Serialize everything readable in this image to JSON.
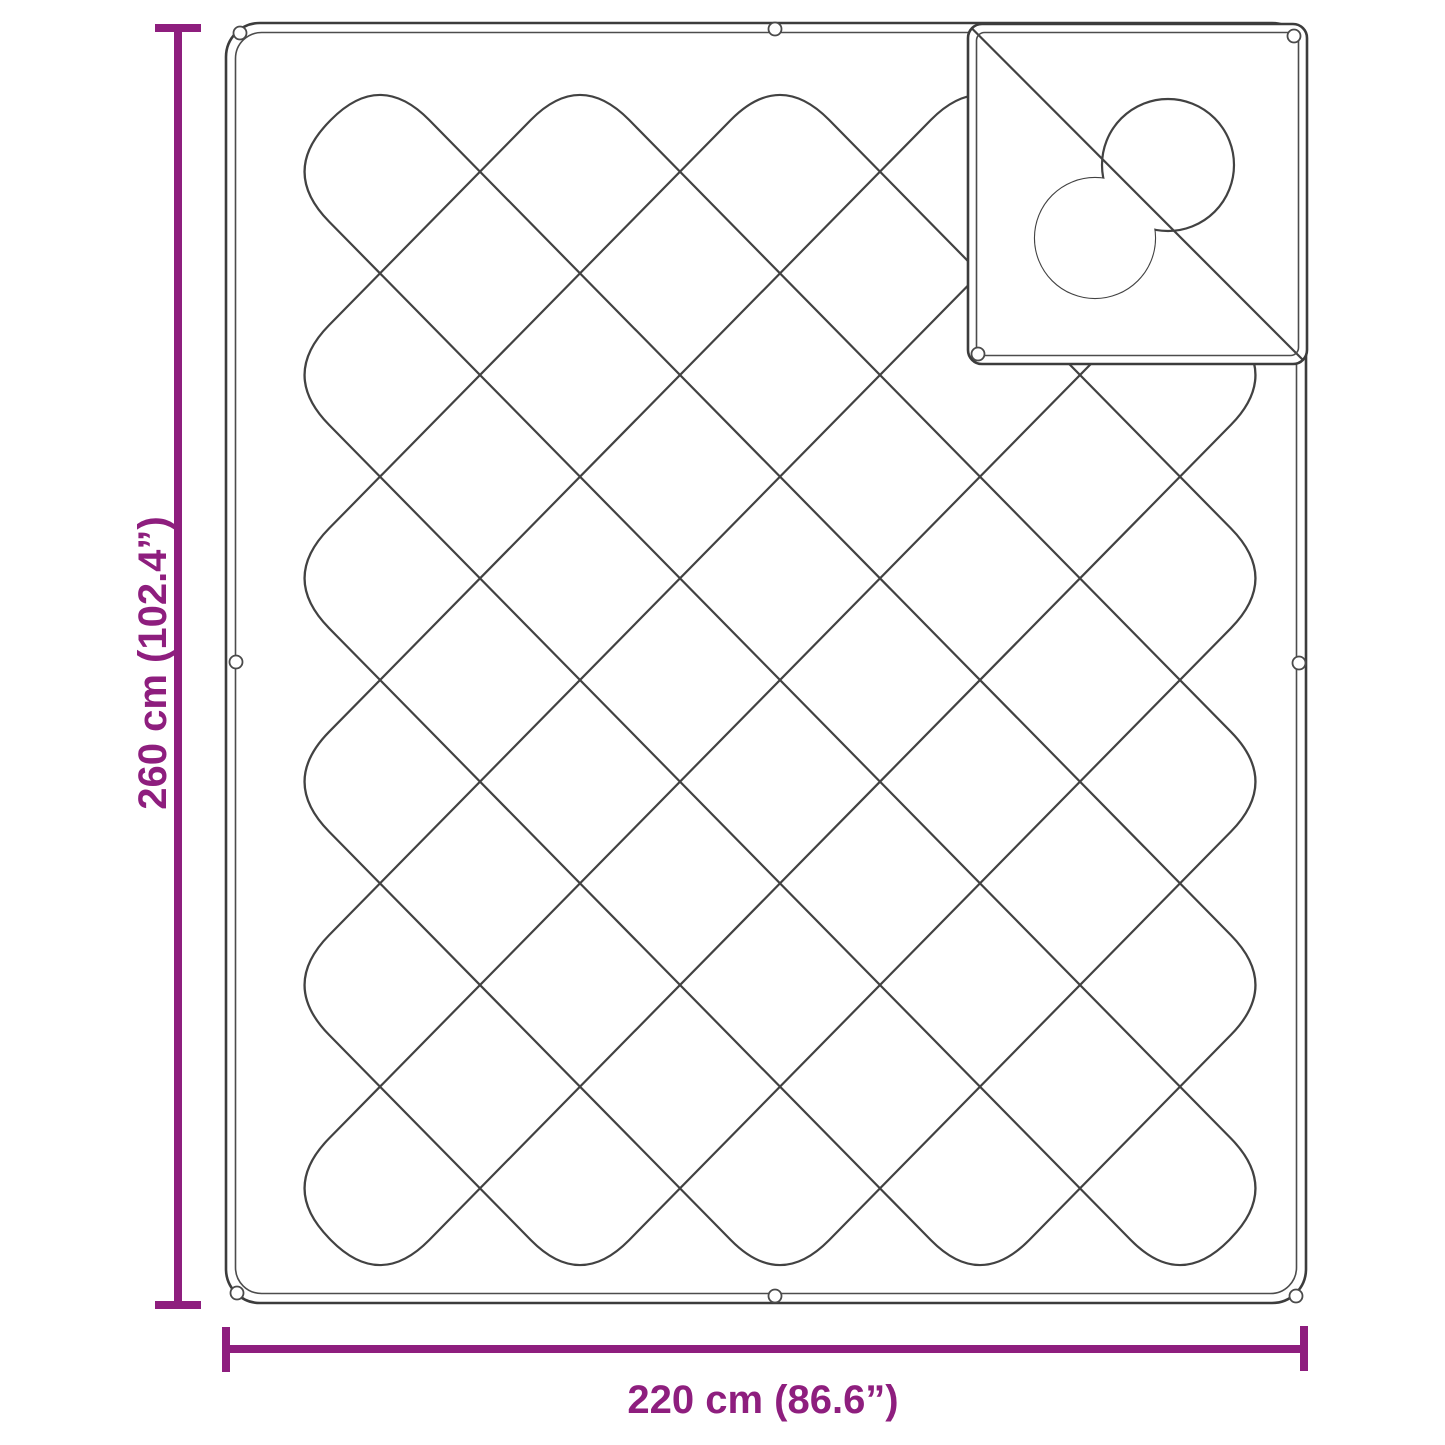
{
  "diagram": {
    "title": "blanket-dimension-diagram",
    "dimensions": {
      "height_label": "260 cm (102.4”)",
      "width_label": "220 cm (86.6”)"
    },
    "colors": {
      "accent": "#8e1e7e",
      "line": "#3c3c3c",
      "background": "#ffffff"
    }
  }
}
